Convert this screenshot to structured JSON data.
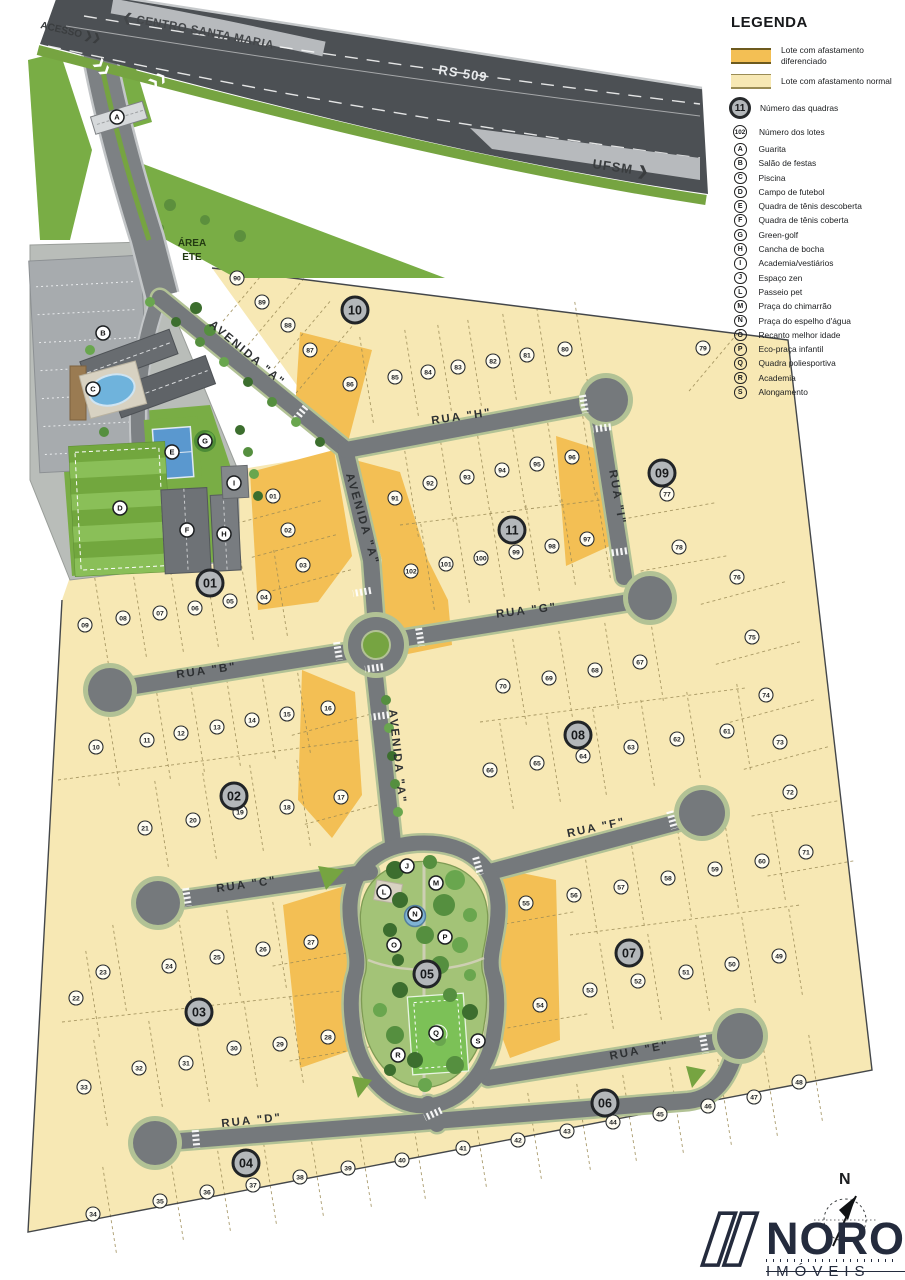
{
  "legend": {
    "title": "LEGENDA",
    "swatches": [
      {
        "kind": "diff",
        "label": "Lote com afastamento diferenciado"
      },
      {
        "kind": "norm",
        "label": "Lote com afastamento normal"
      }
    ],
    "markers": [
      {
        "symbol": "11",
        "style": "block",
        "label": "Número das quadras"
      },
      {
        "symbol": "102",
        "style": "lot",
        "label": "Número dos lotes"
      },
      {
        "symbol": "A",
        "style": "amen",
        "label": "Guarita"
      },
      {
        "symbol": "B",
        "style": "amen",
        "label": "Salão de festas"
      },
      {
        "symbol": "C",
        "style": "amen",
        "label": "Piscina"
      },
      {
        "symbol": "D",
        "style": "amen",
        "label": "Campo de futebol"
      },
      {
        "symbol": "E",
        "style": "amen",
        "label": "Quadra de tênis descoberta"
      },
      {
        "symbol": "F",
        "style": "amen",
        "label": "Quadra de tênis coberta"
      },
      {
        "symbol": "G",
        "style": "amen",
        "label": "Green-golf"
      },
      {
        "symbol": "H",
        "style": "amen",
        "label": "Cancha de bocha"
      },
      {
        "symbol": "I",
        "style": "amen",
        "label": "Academia/vestiários"
      },
      {
        "symbol": "J",
        "style": "amen",
        "label": "Espaço zen"
      },
      {
        "symbol": "L",
        "style": "amen",
        "label": "Passeio pet"
      },
      {
        "symbol": "M",
        "style": "amen",
        "label": "Praça do chimarrão"
      },
      {
        "symbol": "N",
        "style": "amen",
        "label": "Praça do espelho d'água"
      },
      {
        "symbol": "O",
        "style": "amen",
        "label": "Recanto melhor idade"
      },
      {
        "symbol": "P",
        "style": "amen",
        "label": "Eco-praça infantil"
      },
      {
        "symbol": "Q",
        "style": "amen",
        "label": "Quadra poliesportiva"
      },
      {
        "symbol": "R",
        "style": "amen",
        "label": "Academia"
      },
      {
        "symbol": "S",
        "style": "amen",
        "label": "Alongamento"
      }
    ]
  },
  "highway": {
    "route": "RS 509",
    "dir_left": "❮ CENTRO SANTA MARIA",
    "dir_right": "UFSM ❯",
    "access": "ACESSO ❯❯"
  },
  "labels": {
    "area_ete_line1": "ÁREA",
    "area_ete_line2": "ETE",
    "compass": "N"
  },
  "brand": {
    "name": "NORO",
    "sub": "IMÓVEIS"
  },
  "colors": {
    "lot_normal": "#f7e8b4",
    "lot_diff": "#f3bf54",
    "street": "#75797c",
    "highway": "#4c5054",
    "grass": "#79ad45",
    "park": "#a3c377",
    "brand_navy": "#242b3d"
  },
  "map": {
    "street_labels": [
      {
        "t": "RUA \"H\"",
        "x": 462,
        "y": 420,
        "r": -8
      },
      {
        "t": "RUA \"I\"",
        "x": 614,
        "y": 498,
        "r": 80
      },
      {
        "t": "RUA \"G\"",
        "x": 527,
        "y": 614,
        "r": -7
      },
      {
        "t": "RUA \"B\"",
        "x": 207,
        "y": 674,
        "r": -8
      },
      {
        "t": "RUA \"C\"",
        "x": 247,
        "y": 888,
        "r": -8
      },
      {
        "t": "RUA \"F\"",
        "x": 597,
        "y": 831,
        "r": -12
      },
      {
        "t": "RUA \"E\"",
        "x": 640,
        "y": 1054,
        "r": -11
      },
      {
        "t": "RUA \"D\"",
        "x": 252,
        "y": 1124,
        "r": -6
      },
      {
        "t": "AVENIDA \"A\"",
        "x": 245,
        "y": 356,
        "r": 40
      },
      {
        "t": "AVENIDA \"A\"",
        "x": 359,
        "y": 520,
        "r": 74
      },
      {
        "t": "AVENIDA \"A\"",
        "x": 394,
        "y": 757,
        "r": 84
      }
    ],
    "blocks": [
      {
        "n": "01",
        "x": 210,
        "y": 583
      },
      {
        "n": "02",
        "x": 234,
        "y": 796
      },
      {
        "n": "03",
        "x": 199,
        "y": 1012
      },
      {
        "n": "04",
        "x": 246,
        "y": 1163
      },
      {
        "n": "05",
        "x": 427,
        "y": 974
      },
      {
        "n": "06",
        "x": 605,
        "y": 1103
      },
      {
        "n": "07",
        "x": 629,
        "y": 953
      },
      {
        "n": "08",
        "x": 578,
        "y": 735
      },
      {
        "n": "09",
        "x": 662,
        "y": 473
      },
      {
        "n": "10",
        "x": 355,
        "y": 310
      },
      {
        "n": "11",
        "x": 512,
        "y": 530
      }
    ],
    "amenities": [
      {
        "id": "A",
        "x": 117,
        "y": 117
      },
      {
        "id": "B",
        "x": 103,
        "y": 333
      },
      {
        "id": "C",
        "x": 93,
        "y": 389
      },
      {
        "id": "D",
        "x": 120,
        "y": 508
      },
      {
        "id": "E",
        "x": 172,
        "y": 452
      },
      {
        "id": "F",
        "x": 187,
        "y": 530
      },
      {
        "id": "G",
        "x": 205,
        "y": 441
      },
      {
        "id": "H",
        "x": 224,
        "y": 534
      },
      {
        "id": "I",
        "x": 234,
        "y": 483
      },
      {
        "id": "J",
        "x": 407,
        "y": 866
      },
      {
        "id": "L",
        "x": 384,
        "y": 892
      },
      {
        "id": "M",
        "x": 436,
        "y": 883
      },
      {
        "id": "N",
        "x": 415,
        "y": 914
      },
      {
        "id": "O",
        "x": 394,
        "y": 945
      },
      {
        "id": "P",
        "x": 445,
        "y": 937
      },
      {
        "id": "Q",
        "x": 436,
        "y": 1033
      },
      {
        "id": "R",
        "x": 398,
        "y": 1055
      },
      {
        "id": "S",
        "x": 478,
        "y": 1041
      }
    ],
    "lots": [
      {
        "n": "01",
        "x": 273,
        "y": 496,
        "a": 165
      },
      {
        "n": "02",
        "x": 288,
        "y": 530,
        "a": 165
      },
      {
        "n": "03",
        "x": 303,
        "y": 565,
        "a": 165
      },
      {
        "n": "04",
        "x": 264,
        "y": 597
      },
      {
        "n": "05",
        "x": 230,
        "y": 601
      },
      {
        "n": "06",
        "x": 195,
        "y": 608
      },
      {
        "n": "07",
        "x": 160,
        "y": 613
      },
      {
        "n": "08",
        "x": 123,
        "y": 618
      },
      {
        "n": "09",
        "x": 85,
        "y": 625
      },
      {
        "n": "10",
        "x": 96,
        "y": 747
      },
      {
        "n": "11",
        "x": 147,
        "y": 740
      },
      {
        "n": "12",
        "x": 181,
        "y": 733
      },
      {
        "n": "13",
        "x": 217,
        "y": 727
      },
      {
        "n": "14",
        "x": 252,
        "y": 720
      },
      {
        "n": "15",
        "x": 287,
        "y": 714
      },
      {
        "n": "16",
        "x": 328,
        "y": 708,
        "a": 165
      },
      {
        "n": "17",
        "x": 341,
        "y": 797,
        "a": 165
      },
      {
        "n": "18",
        "x": 287,
        "y": 807
      },
      {
        "n": "19",
        "x": 240,
        "y": 812
      },
      {
        "n": "20",
        "x": 193,
        "y": 820
      },
      {
        "n": "21",
        "x": 145,
        "y": 828
      },
      {
        "n": "22",
        "x": 76,
        "y": 998
      },
      {
        "n": "23",
        "x": 103,
        "y": 972
      },
      {
        "n": "24",
        "x": 169,
        "y": 966
      },
      {
        "n": "25",
        "x": 217,
        "y": 957
      },
      {
        "n": "26",
        "x": 263,
        "y": 949
      },
      {
        "n": "27",
        "x": 311,
        "y": 942,
        "a": 170
      },
      {
        "n": "28",
        "x": 328,
        "y": 1037,
        "a": 170
      },
      {
        "n": "29",
        "x": 280,
        "y": 1044
      },
      {
        "n": "30",
        "x": 234,
        "y": 1048
      },
      {
        "n": "31",
        "x": 186,
        "y": 1063
      },
      {
        "n": "32",
        "x": 139,
        "y": 1068
      },
      {
        "n": "33",
        "x": 84,
        "y": 1087
      },
      {
        "n": "34",
        "x": 93,
        "y": 1214
      },
      {
        "n": "35",
        "x": 160,
        "y": 1201
      },
      {
        "n": "36",
        "x": 207,
        "y": 1192
      },
      {
        "n": "37",
        "x": 253,
        "y": 1185
      },
      {
        "n": "38",
        "x": 300,
        "y": 1177
      },
      {
        "n": "39",
        "x": 348,
        "y": 1168
      },
      {
        "n": "40",
        "x": 402,
        "y": 1160
      },
      {
        "n": "41",
        "x": 463,
        "y": 1148
      },
      {
        "n": "42",
        "x": 518,
        "y": 1140
      },
      {
        "n": "43",
        "x": 567,
        "y": 1131
      },
      {
        "n": "44",
        "x": 613,
        "y": 1122
      },
      {
        "n": "45",
        "x": 660,
        "y": 1114
      },
      {
        "n": "46",
        "x": 708,
        "y": 1106
      },
      {
        "n": "47",
        "x": 754,
        "y": 1097
      },
      {
        "n": "48",
        "x": 799,
        "y": 1082
      },
      {
        "n": "49",
        "x": 779,
        "y": 956
      },
      {
        "n": "50",
        "x": 732,
        "y": 964
      },
      {
        "n": "51",
        "x": 686,
        "y": 972
      },
      {
        "n": "52",
        "x": 638,
        "y": 981
      },
      {
        "n": "53",
        "x": 590,
        "y": 990
      },
      {
        "n": "54",
        "x": 540,
        "y": 1005,
        "a": 170
      },
      {
        "n": "55",
        "x": 526,
        "y": 903,
        "a": 170
      },
      {
        "n": "56",
        "x": 574,
        "y": 895
      },
      {
        "n": "57",
        "x": 621,
        "y": 887
      },
      {
        "n": "58",
        "x": 668,
        "y": 878
      },
      {
        "n": "59",
        "x": 715,
        "y": 869
      },
      {
        "n": "60",
        "x": 762,
        "y": 861
      },
      {
        "n": "61",
        "x": 727,
        "y": 731
      },
      {
        "n": "62",
        "x": 677,
        "y": 739
      },
      {
        "n": "63",
        "x": 631,
        "y": 747
      },
      {
        "n": "64",
        "x": 583,
        "y": 756
      },
      {
        "n": "65",
        "x": 537,
        "y": 763
      },
      {
        "n": "66",
        "x": 490,
        "y": 770
      },
      {
        "n": "67",
        "x": 640,
        "y": 662
      },
      {
        "n": "68",
        "x": 595,
        "y": 670
      },
      {
        "n": "69",
        "x": 549,
        "y": 678
      },
      {
        "n": "70",
        "x": 503,
        "y": 686
      },
      {
        "n": "71",
        "x": 806,
        "y": 852,
        "a": 170
      },
      {
        "n": "72",
        "x": 790,
        "y": 792,
        "a": 170
      },
      {
        "n": "73",
        "x": 780,
        "y": 742,
        "a": 165
      },
      {
        "n": "74",
        "x": 766,
        "y": 695,
        "a": 165
      },
      {
        "n": "75",
        "x": 752,
        "y": 637,
        "a": 165
      },
      {
        "n": "76",
        "x": 737,
        "y": 577,
        "a": 165
      },
      {
        "n": "77",
        "x": 667,
        "y": 494,
        "a": 170
      },
      {
        "n": "78",
        "x": 679,
        "y": 547,
        "a": 170
      },
      {
        "n": "79",
        "x": 703,
        "y": 348,
        "a": 130
      },
      {
        "n": "80",
        "x": 565,
        "y": 349
      },
      {
        "n": "81",
        "x": 527,
        "y": 355
      },
      {
        "n": "82",
        "x": 493,
        "y": 361
      },
      {
        "n": "83",
        "x": 458,
        "y": 367
      },
      {
        "n": "84",
        "x": 428,
        "y": 372
      },
      {
        "n": "85",
        "x": 395,
        "y": 377
      },
      {
        "n": "86",
        "x": 350,
        "y": 384
      },
      {
        "n": "87",
        "x": 310,
        "y": 350,
        "a": 130
      },
      {
        "n": "88",
        "x": 288,
        "y": 325,
        "a": 130
      },
      {
        "n": "89",
        "x": 262,
        "y": 302,
        "a": 130
      },
      {
        "n": "90",
        "x": 237,
        "y": 278,
        "a": 130
      },
      {
        "n": "91",
        "x": 395,
        "y": 498
      },
      {
        "n": "92",
        "x": 430,
        "y": 483
      },
      {
        "n": "93",
        "x": 467,
        "y": 477
      },
      {
        "n": "94",
        "x": 502,
        "y": 470
      },
      {
        "n": "95",
        "x": 537,
        "y": 464
      },
      {
        "n": "96",
        "x": 572,
        "y": 457
      },
      {
        "n": "97",
        "x": 587,
        "y": 539
      },
      {
        "n": "98",
        "x": 552,
        "y": 546
      },
      {
        "n": "99",
        "x": 516,
        "y": 552
      },
      {
        "n": "100",
        "x": 481,
        "y": 558
      },
      {
        "n": "101",
        "x": 446,
        "y": 564
      },
      {
        "n": "102",
        "x": 411,
        "y": 571
      }
    ]
  }
}
